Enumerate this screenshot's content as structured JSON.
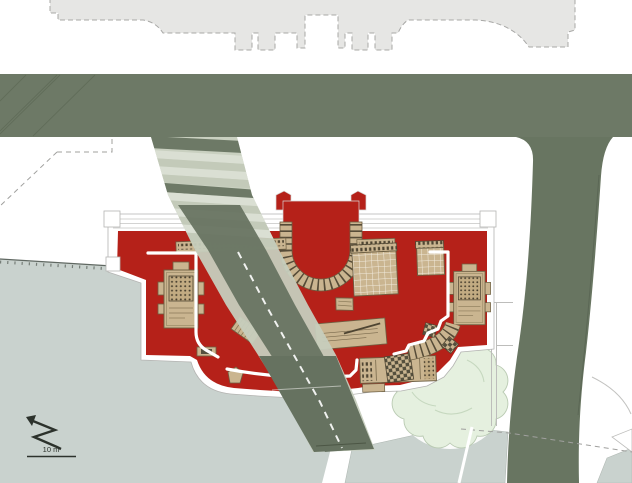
{
  "plan": {
    "type": "architectural-site-plan",
    "scale": {
      "label": "10 m"
    },
    "colors": {
      "background": "#ffffff",
      "road": "#6d7966",
      "road_vertical": "#687561",
      "ramp_core": "#667260",
      "ramp_side_strip": "#c6cdbd",
      "stair_light": "#dadfd3",
      "stair_mid": "#c3cab9",
      "building_red": "#b52119",
      "north_block_gray": "#e6e6e4",
      "plaza_gray": "#c9d2ce",
      "tree_green": "#e5f0df",
      "tan_detail": "#cab590",
      "tan_dark": "#6d5f42",
      "annotation": "#2c322c"
    },
    "elements": {
      "north_block": "existing building block (north side)",
      "main_road": "main street (east-west)",
      "side_road": "street branch (south, right)",
      "ramp": "diagonal ramp with stairs crossing excavation",
      "red_building": "excavated palace footprint (red)",
      "apse": "central apse with semicircular colonnade",
      "monument_left": "western monument base",
      "monument_right": "eastern monument base",
      "coffer_grid_main": "coffered floor grid",
      "coffer_grid_small": "small coffered grid",
      "stair_cluster": "south-east stairs and curved colonnade arm",
      "plaza": "lower terrace / plaza (gray)",
      "tree": "existing tree",
      "north_arrow": "north arrow",
      "scale_bar": "graphic scale"
    }
  }
}
